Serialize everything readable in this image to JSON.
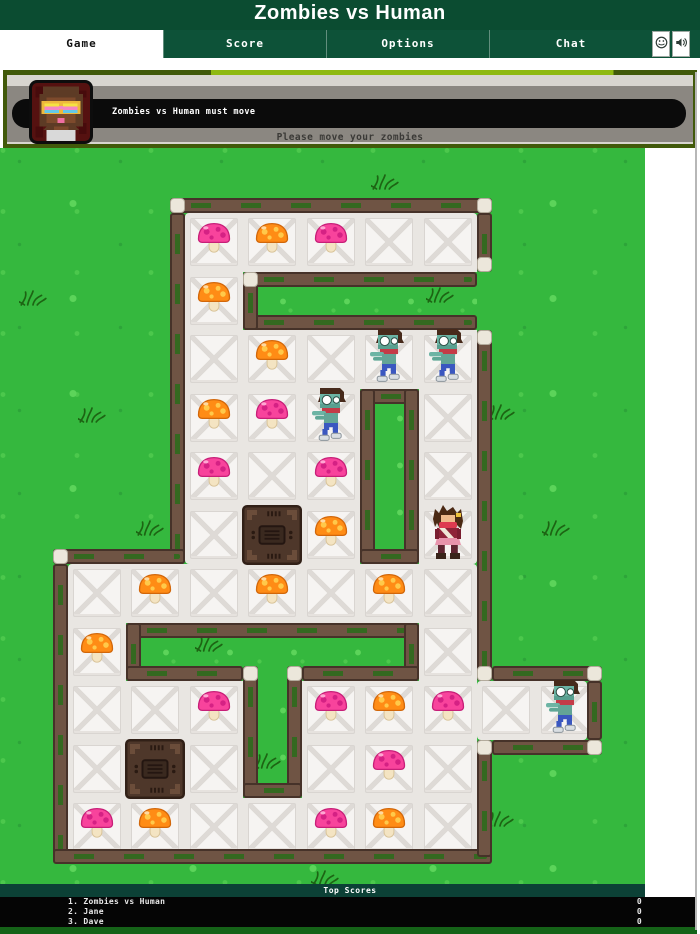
{
  "title": "Zombies vs Human",
  "tabs": [
    {
      "label": "Game",
      "active": true
    },
    {
      "label": "Score",
      "active": false
    },
    {
      "label": "Options",
      "active": false
    },
    {
      "label": "Chat",
      "active": false
    }
  ],
  "toolbar_icons": [
    "smiley-icon",
    "sound-icon"
  ],
  "message_panel": {
    "headline": "Zombies vs Human must move",
    "subline": "Please move your zombies",
    "avatar": "pixel-avatar"
  },
  "scoreboard": {
    "title": "Top Scores",
    "rows": [
      {
        "name": "1. Zombies vs Human",
        "score": "0"
      },
      {
        "name": "2. Jane",
        "score": "0"
      },
      {
        "name": "3. Dave",
        "score": "0"
      }
    ]
  },
  "colors": {
    "header_green": "#0b4c31",
    "tabbar_green": "#0d5238",
    "panel_border": "#41590a",
    "panel_accent": "#8fb912",
    "grass": "#35b83e",
    "wall_brown": "#6f5444",
    "floor": "#f6f4f2",
    "mushroom_pink": "#f8439c",
    "mushroom_orange": "#ff8c15",
    "score_teal": "#0c4136",
    "bottom_green": "#156318"
  },
  "board": {
    "grid": {
      "ox": 67.5,
      "oy": 65,
      "t": 58.5
    },
    "rooms": [
      [
        184.5,
        65,
        292.5,
        351
      ],
      [
        67.5,
        416,
        409.5,
        292.5
      ],
      [
        477,
        533,
        109.5,
        58.5
      ]
    ],
    "corridors": [
      [
        243,
        123.5,
        234,
        58.5
      ],
      [
        360,
        240.5,
        58.5,
        175.5
      ],
      [
        126,
        474.5,
        292.5,
        58.5
      ],
      [
        243,
        533,
        58.5,
        117
      ]
    ],
    "floor_cells": [
      [
        2,
        0
      ],
      [
        3,
        0
      ],
      [
        4,
        0
      ],
      [
        5,
        0
      ],
      [
        6,
        0
      ],
      [
        2,
        1
      ],
      [
        2,
        2
      ],
      [
        3,
        2
      ],
      [
        4,
        2
      ],
      [
        5,
        2
      ],
      [
        6,
        2
      ],
      [
        2,
        3
      ],
      [
        3,
        3
      ],
      [
        4,
        3
      ],
      [
        6,
        3
      ],
      [
        2,
        4
      ],
      [
        3,
        4
      ],
      [
        4,
        4
      ],
      [
        6,
        4
      ],
      [
        2,
        5
      ],
      [
        3,
        5
      ],
      [
        4,
        5
      ],
      [
        6,
        5
      ],
      [
        0,
        6
      ],
      [
        1,
        6
      ],
      [
        2,
        6
      ],
      [
        3,
        6
      ],
      [
        4,
        6
      ],
      [
        5,
        6
      ],
      [
        6,
        6
      ],
      [
        0,
        7
      ],
      [
        6,
        7
      ],
      [
        0,
        8
      ],
      [
        1,
        8
      ],
      [
        2,
        8
      ],
      [
        4,
        8
      ],
      [
        5,
        8
      ],
      [
        6,
        8
      ],
      [
        7,
        8
      ],
      [
        8,
        8
      ],
      [
        0,
        9
      ],
      [
        1,
        9
      ],
      [
        2,
        9
      ],
      [
        4,
        9
      ],
      [
        5,
        9
      ],
      [
        6,
        9
      ],
      [
        0,
        10
      ],
      [
        1,
        10
      ],
      [
        2,
        10
      ],
      [
        3,
        10
      ],
      [
        4,
        10
      ],
      [
        5,
        10
      ],
      [
        6,
        10
      ]
    ],
    "walls": [
      [
        169.5,
        50,
        322.5,
        15
      ],
      [
        169.5,
        65,
        15,
        351
      ],
      [
        52.5,
        401,
        132,
        15
      ],
      [
        52.5,
        416,
        15,
        292.5
      ],
      [
        52.5,
        701,
        439.5,
        15
      ],
      [
        477,
        65,
        15,
        58.5
      ],
      [
        477,
        182,
        15,
        351
      ],
      [
        477,
        591.5,
        15,
        117
      ],
      [
        243,
        123.5,
        234,
        15
      ],
      [
        243,
        167,
        234,
        15
      ],
      [
        243,
        123.5,
        15,
        58.5
      ],
      [
        360,
        240.5,
        58.5,
        15
      ],
      [
        360,
        240.5,
        15,
        175.5
      ],
      [
        403.5,
        240.5,
        15,
        175.5
      ],
      [
        360,
        401,
        58.5,
        15
      ],
      [
        126,
        474.5,
        292.5,
        15
      ],
      [
        126,
        474.5,
        15,
        58.5
      ],
      [
        403.5,
        474.5,
        15,
        58.5
      ],
      [
        126,
        518,
        117,
        15
      ],
      [
        301.5,
        518,
        117,
        15
      ],
      [
        243,
        518,
        15,
        132
      ],
      [
        286.5,
        518,
        15,
        132
      ],
      [
        243,
        635,
        58.5,
        15
      ],
      [
        492,
        518,
        109.5,
        15
      ],
      [
        492,
        591.5,
        109.5,
        15
      ],
      [
        586.5,
        533,
        15,
        58.5
      ]
    ],
    "caps": [
      [
        169.5,
        50
      ],
      [
        477,
        50
      ],
      [
        477,
        108.5
      ],
      [
        477,
        182
      ],
      [
        243,
        123.5
      ],
      [
        52.5,
        401
      ],
      [
        477,
        518
      ],
      [
        477,
        591.5
      ],
      [
        586.5,
        518
      ],
      [
        586.5,
        591.5
      ],
      [
        243,
        518
      ],
      [
        286.5,
        518
      ]
    ],
    "entities": [
      {
        "type": "crate",
        "col": 3,
        "row": 5
      },
      {
        "type": "crate",
        "col": 1,
        "row": 9
      },
      {
        "type": "mushroom-pink",
        "col": 2,
        "row": 0
      },
      {
        "type": "mushroom-orange",
        "col": 3,
        "row": 0
      },
      {
        "type": "mushroom-pink",
        "col": 4,
        "row": 0
      },
      {
        "type": "mushroom-orange",
        "col": 2,
        "row": 1
      },
      {
        "type": "mushroom-orange",
        "col": 3,
        "row": 2
      },
      {
        "type": "mushroom-orange",
        "col": 2,
        "row": 3
      },
      {
        "type": "mushroom-pink",
        "col": 3,
        "row": 3
      },
      {
        "type": "mushroom-pink",
        "col": 2,
        "row": 4
      },
      {
        "type": "mushroom-pink",
        "col": 4,
        "row": 4
      },
      {
        "type": "mushroom-orange",
        "col": 4,
        "row": 5
      },
      {
        "type": "mushroom-orange",
        "col": 1,
        "row": 6
      },
      {
        "type": "mushroom-orange",
        "col": 3,
        "row": 6
      },
      {
        "type": "mushroom-orange",
        "col": 5,
        "row": 6
      },
      {
        "type": "mushroom-orange",
        "col": 0,
        "row": 7
      },
      {
        "type": "mushroom-pink",
        "col": 2,
        "row": 8
      },
      {
        "type": "mushroom-pink",
        "col": 4,
        "row": 8
      },
      {
        "type": "mushroom-orange",
        "col": 5,
        "row": 8
      },
      {
        "type": "mushroom-pink",
        "col": 6,
        "row": 8
      },
      {
        "type": "mushroom-pink",
        "col": 5,
        "row": 9
      },
      {
        "type": "mushroom-pink",
        "col": 0,
        "row": 10
      },
      {
        "type": "mushroom-orange",
        "col": 1,
        "row": 10
      },
      {
        "type": "mushroom-pink",
        "col": 4,
        "row": 10
      },
      {
        "type": "mushroom-orange",
        "col": 5,
        "row": 10
      },
      {
        "type": "zombie",
        "col": 5,
        "row": 2
      },
      {
        "type": "zombie",
        "col": 6,
        "row": 2
      },
      {
        "type": "zombie",
        "col": 4,
        "row": 3
      },
      {
        "type": "zombie",
        "col": 8,
        "row": 8
      },
      {
        "type": "human",
        "col": 6,
        "row": 5
      }
    ],
    "tufts": [
      [
        385,
        34
      ],
      [
        33,
        150
      ],
      [
        92,
        267
      ],
      [
        501,
        264
      ],
      [
        440,
        147
      ],
      [
        556,
        380
      ],
      [
        150,
        380
      ],
      [
        209,
        496
      ],
      [
        267,
        613
      ],
      [
        500,
        671
      ],
      [
        325,
        730
      ]
    ]
  }
}
